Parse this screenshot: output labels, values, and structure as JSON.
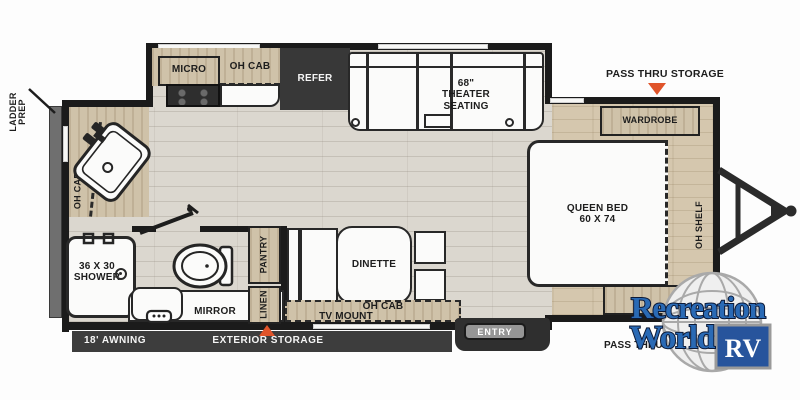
{
  "exterior": {
    "ladder_prep_1": "LADDER",
    "ladder_prep_2": "PREP",
    "pass_thru_top": "PASS THRU STORAGE",
    "pass_thru_bottom": "PASS THRU STORAGE",
    "awning": "18' AWNING",
    "exterior_storage": "EXTERIOR STORAGE",
    "entry": "ENTRY"
  },
  "kitchen": {
    "micro": "MICRO",
    "oh_cab": "OH CAB",
    "refer": "REFER"
  },
  "living": {
    "theater_size": "68\"",
    "theater_1": "THEATER",
    "theater_2": "SEATING",
    "dinette": "DINETTE",
    "oh_cab": "OH CAB",
    "tv_mount": "TV MOUNT",
    "pantry": "PANTRY",
    "linen": "LINEN"
  },
  "bath": {
    "oh_cab": "OH CAB",
    "shower_1": "36 X 30",
    "shower_2": "SHOWER",
    "mirror": "MIRROR"
  },
  "bedroom": {
    "wardrobe": "WARDROBE",
    "bed_1": "QUEEN BED",
    "bed_2": "60 X 74",
    "oh_shelf": "OH SHELF"
  },
  "logo": {
    "name_1": "Recreation",
    "name_2": "World",
    "badge": "RV"
  },
  "colors": {
    "wall": "#1b1b1b",
    "wood": "#cfc2a9",
    "floor": "#dbd7cf",
    "accent_orange": "#e0542a",
    "logo_blue": "#2a6ab5"
  }
}
